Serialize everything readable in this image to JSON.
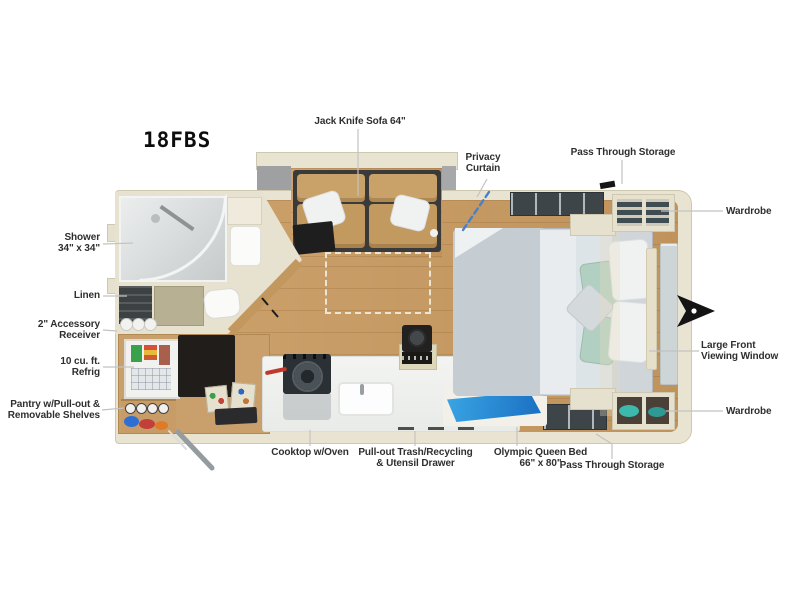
{
  "title": "18FBS",
  "labels": {
    "shower": "Shower\n34\" x 34\"",
    "linen": "Linen",
    "accessory_receiver": "2\" Accessory\nReceiver",
    "refrigerator": "10 cu. ft.\nRefrig",
    "pantry": "Pantry w/Pull-out &\nRemovable Shelves",
    "sofa": "Jack Knife Sofa 64\"",
    "privacy_curtain": "Privacy\nCurtain",
    "pass_through_top": "Pass Through Storage",
    "wardrobe_top": "Wardrobe",
    "front_window": "Large Front\nViewing Window",
    "wardrobe_bottom": "Wardrobe",
    "cooktop": "Cooktop w/Oven",
    "trash_drawer": "Pull-out Trash/Recycling\n& Utensil Drawer",
    "bed": "Olympic Queen Bed\n66\" x 80\"",
    "pass_through_bottom": "Pass Through Storage"
  },
  "colors": {
    "wall_cream": "#e9e4d2",
    "floor_wood": "#c79e69",
    "sofa_tan": "#c9a269",
    "bed_gray": "#cfd5d9",
    "pillow_green": "#b2d0c1",
    "privacy_curtain_blue": "#4b80c2",
    "wedge_blue": "#1c7fd6",
    "clothes_teal": "#3cb8ad",
    "label_text": "#2f2f2f",
    "leader_line": "#c2c2c2",
    "hitch_black": "#141414"
  }
}
